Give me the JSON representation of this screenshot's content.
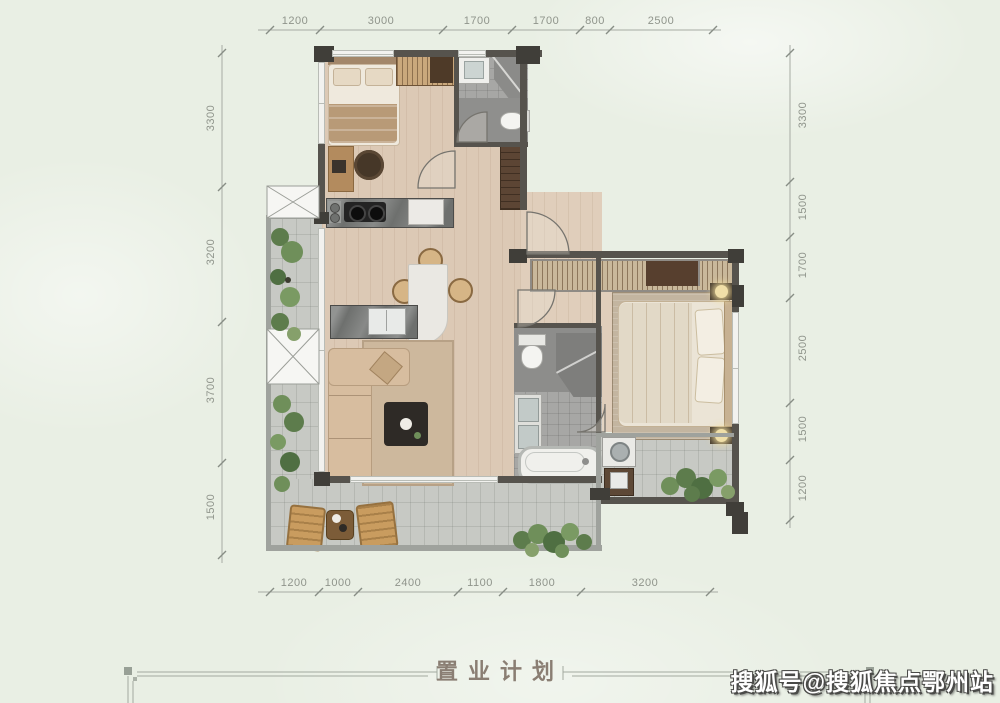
{
  "title_block": {
    "title": "置业计划"
  },
  "watermark": {
    "text": "搜狐号@搜狐焦点鄂州站"
  },
  "dimensions": {
    "top": [
      "1200",
      "3000",
      "1700",
      "1700",
      "800",
      "2500"
    ],
    "bottom": [
      "1200",
      "1000",
      "2400",
      "1100",
      "1800",
      "3200"
    ],
    "left": [
      "3300",
      "3200",
      "3700",
      "1500"
    ],
    "right": [
      "3300",
      "1500",
      "1700",
      "2500",
      "1500",
      "1200"
    ]
  },
  "colors": {
    "background": "#e9efe4",
    "wall": "#56534d",
    "wood_floor": "#dcc9b5",
    "tile_floor": "#c7c9c4",
    "bath_floor": "#a7a7a5",
    "plant_green": "#5f7d4c",
    "dimension_text": "#8f948b",
    "title_text": "#8a7e73",
    "watermark_fill": "#ffffff"
  }
}
